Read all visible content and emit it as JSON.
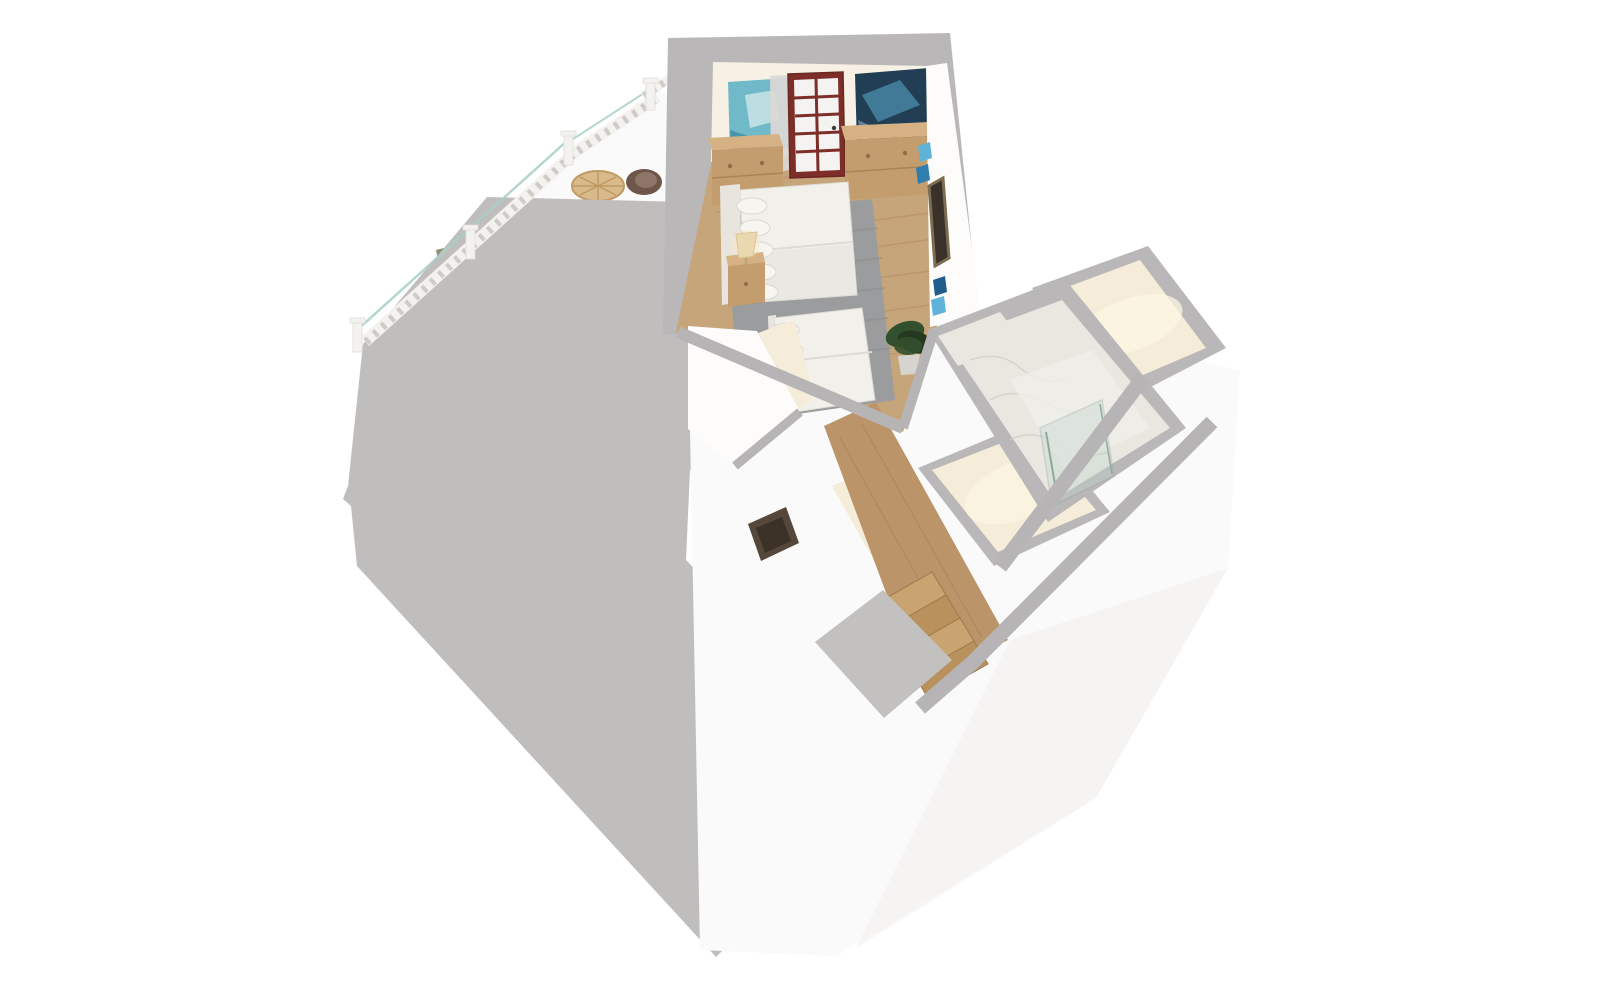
{
  "meta": {
    "title": "3D dollhouse floor plan render — upper level",
    "render_type": "isometric cutaway floor plan",
    "has_text": false
  },
  "palette": {
    "bg": "#ffffff",
    "roof": "#c0bdbd",
    "roofSmall": "#c3c0c0",
    "frame": "#bab7b8",
    "band": "#b7b4b6",
    "facade": "#fbfafa",
    "facadeShade": "#f1f0ef",
    "wallBright": "#fdfcfa",
    "wallBack": "#f6f1e4",
    "creamWall": "#f5edd9",
    "creamGlow": "#fbf5e3",
    "marble": "#e9e7e0",
    "marbleVein": "#d2cfc6",
    "marbleFloor": "#efede7",
    "glass": "#bcd6cd",
    "glassEdge": "#8fa89e",
    "woodBedroom": "#c7a57a",
    "woodPlank": "#b28c5e",
    "woodHall": "#bb9569",
    "stairTread": "#c9a471",
    "stairTreadAlt": "#b8915c",
    "stairShadow": "#9c7a4e",
    "darkOpening": "#55473a",
    "darkOpeningDeep": "#3a2f26",
    "rug": "#9b9c9e",
    "rugDark": "#8d8e90",
    "bedWhite": "#f2f0ea",
    "bedShadow": "#dedbd4",
    "pillow": "#f7f5f1",
    "pillowEdge": "#dcd8d0",
    "headboard": "#e8e5df",
    "dresser": "#c49d6e",
    "dresserTop": "#d6b183",
    "drawerLine": "#a8845a",
    "knob": "#8a6f4b",
    "doorRed": "#7e2e28",
    "doorRedDark": "#6b2722",
    "doorPane": "#f4f3f1",
    "curtain": "#dbd8d5",
    "artTeal": "#6fb9c8",
    "artTealLight": "#cfe7e8",
    "artTealDeep": "#2e7f9a",
    "artNavy": "#223e54",
    "artNavySwirl": "#4b8fae",
    "artNavyLight": "#9fc6d8",
    "mirror": "#3a322a",
    "mirrorFrame": "#7c6c50",
    "decorBlue1": "#2e7fb0",
    "decorBlue2": "#5fb3d8",
    "decorBlue3": "#1f5e8c",
    "lampShade": "#ead9b0",
    "lampShadeEdge": "#d9c694",
    "lampGlow": "#f6e8c4",
    "lampStem": "#b9a87e",
    "plantGreen": "#33502e",
    "plantDark": "#24391f",
    "pot": "#d7d4cf",
    "railWhite": "#f4f2ef",
    "railShadow": "#e0ddd8",
    "railGap": "#cfccc8",
    "glassRail": "#a8cfc9",
    "tableWicker": "#d9ba8b",
    "tableEdge": "#c09a63",
    "chairBrown": "#6e564a",
    "chairSeat": "#8d7668",
    "chairOlive": "#8f8f6f",
    "doorLeaf": "#f1ebdf",
    "doorLeafEdge": "#d8d2c4"
  },
  "scene": {
    "view": "rotated ~45° dollhouse cutaway on white background",
    "areas": [
      {
        "name": "balcony",
        "objects": [
          "white-baluster-railing",
          "glass-panel-strip",
          "round-wicker-table",
          "brown-curved-chair",
          "olive-chair"
        ]
      },
      {
        "name": "bedroom",
        "objects": [
          "red-french-door",
          "sheer-curtain",
          "teal-abstract-art",
          "navy-abstract-art",
          "oak-dresser-left",
          "oak-dresser-right",
          "bed-upper",
          "bed-lower",
          "pillows",
          "nightstand",
          "table-lamp",
          "gray-area-rug",
          "potted-plant",
          "wall-mirror",
          "blue-wall-decor",
          "oak-plank-floor"
        ]
      },
      {
        "name": "bathroom",
        "objects": [
          "marble-walls",
          "marble-floor",
          "glass-shower-enclosure"
        ]
      },
      {
        "name": "room-northeast",
        "objects": [
          "empty-cream-lit-room"
        ]
      },
      {
        "name": "room-southeast",
        "objects": [
          "empty-cream-lit-room"
        ]
      },
      {
        "name": "hallway",
        "objects": [
          "wood-floor",
          "descending-staircase",
          "closet-with-door-leaf",
          "dark-stair-opening"
        ]
      },
      {
        "name": "roof",
        "objects": [
          "main-gray-roof-plane",
          "small-gray-roof-plane",
          "white-exterior-facades"
        ]
      }
    ]
  }
}
